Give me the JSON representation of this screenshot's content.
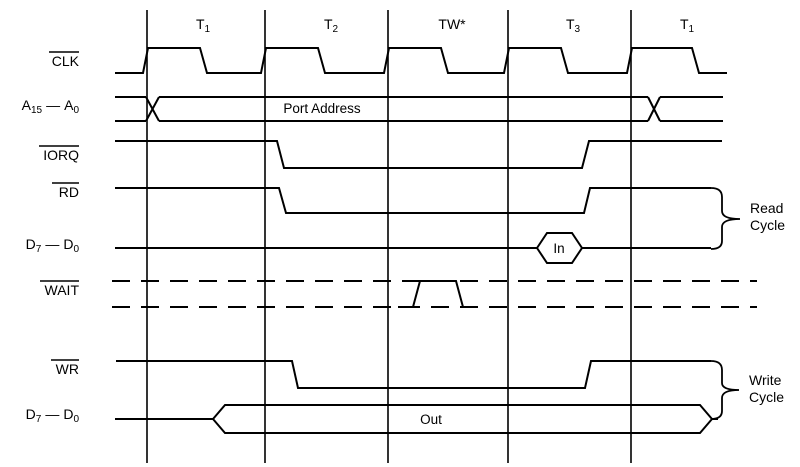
{
  "labels": {
    "clk": {
      "text": "CLK",
      "overline": true
    },
    "a_bus": {
      "p1": "A",
      "s1": "15",
      "mid": "—",
      "p2": "A",
      "s2": "0",
      "overline": false
    },
    "iorq": {
      "text": "IORQ",
      "overline": true
    },
    "rd": {
      "text": "RD",
      "overline": true
    },
    "d_bus_read": {
      "p1": "D",
      "s1": "7",
      "mid": "—",
      "p2": "D",
      "s2": "0",
      "overline": false
    },
    "wait": {
      "text": "WAIT",
      "overline": true
    },
    "wr": {
      "text": "WR",
      "overline": true
    },
    "d_bus_write": {
      "p1": "D",
      "s1": "7",
      "mid": "—",
      "p2": "D",
      "s2": "0",
      "overline": false
    }
  },
  "t_states": [
    {
      "base": "T",
      "sub": "1"
    },
    {
      "base": "T",
      "sub": "2"
    },
    {
      "base": "TW*",
      "sub": ""
    },
    {
      "base": "T",
      "sub": "3"
    },
    {
      "base": "T",
      "sub": "1"
    }
  ],
  "annotations": {
    "port_address": "Port Address",
    "data_in": "In",
    "data_out": "Out",
    "read_cycle": {
      "line1": "Read",
      "line2": "Cycle"
    },
    "write_cycle": {
      "line1": "Write",
      "line2": "Cycle"
    }
  },
  "colors": {
    "line": "#000000",
    "background": "#ffffff"
  }
}
